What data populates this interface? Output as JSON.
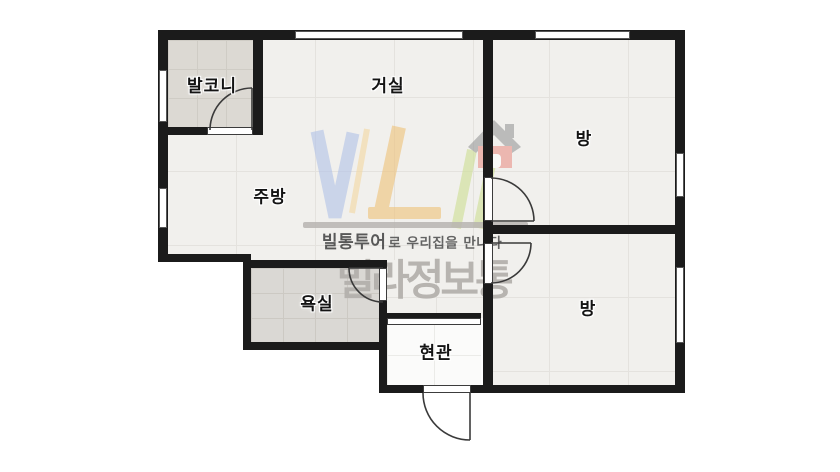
{
  "title": "apartment-floorplan",
  "rooms": {
    "balcony": {
      "label": "발코니"
    },
    "living": {
      "label": "거실"
    },
    "kitchen": {
      "label": "주방"
    },
    "bath": {
      "label": "욕실"
    },
    "entry": {
      "label": "현관"
    },
    "room_top": {
      "label": "방"
    },
    "room_bottom": {
      "label": "방"
    }
  },
  "watermark": {
    "logo_monogram": "VL",
    "tour_brand": "빌통투어",
    "tagline_rest": "로 우리집을 만나다",
    "brand_name": "빌라정보통"
  },
  "colors": {
    "wall": "#1b1b1b",
    "door_stroke": "#3a3a3a",
    "floor_marble": "#f1f0ed",
    "floor_tile": "#dcd9d3",
    "floor_bath": "#dad8d4",
    "floor_entry": "#fbfbfa",
    "wm_blue": "#b3c3e8",
    "wm_yellow": "#eec37c",
    "wm_green": "#cfdf96",
    "wm_red": "#e9958c",
    "wm_roof": "#9b9b9b",
    "wm_gray_bar": "#b7b4b0",
    "wm_text_dark": "#4c4c4c",
    "wm_text_light": "#b4b1ad"
  }
}
